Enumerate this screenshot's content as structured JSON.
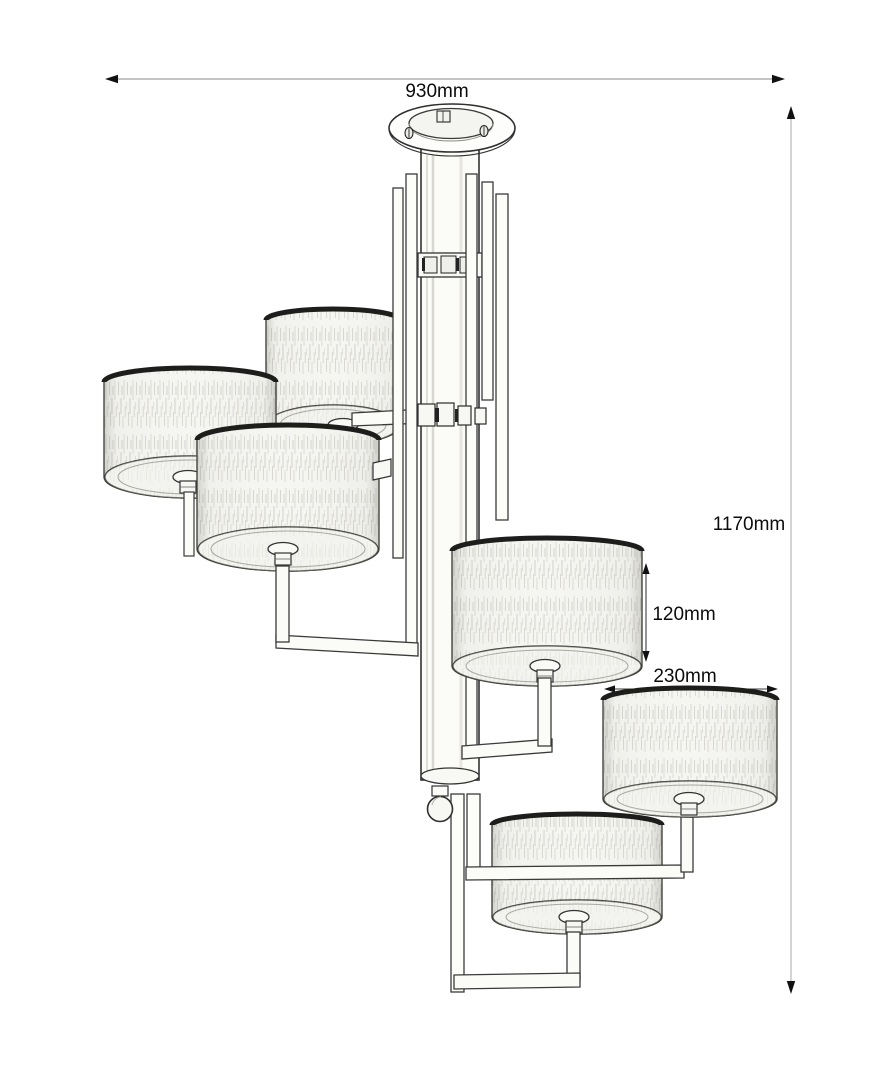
{
  "diagram": {
    "subject": "six-light drum-shade chandelier dimension drawing",
    "shade_count": 6,
    "annotations": {
      "overall_width": "930mm",
      "overall_height": "1170mm",
      "shade_height": "120mm",
      "shade_diameter": "230mm"
    },
    "colors": {
      "background": "#ffffff",
      "line": "#2f2f2f",
      "fabric": "#f5f5f1",
      "top_rim": "#1d1d1b",
      "dimension_line": "#8a8a8a"
    }
  }
}
